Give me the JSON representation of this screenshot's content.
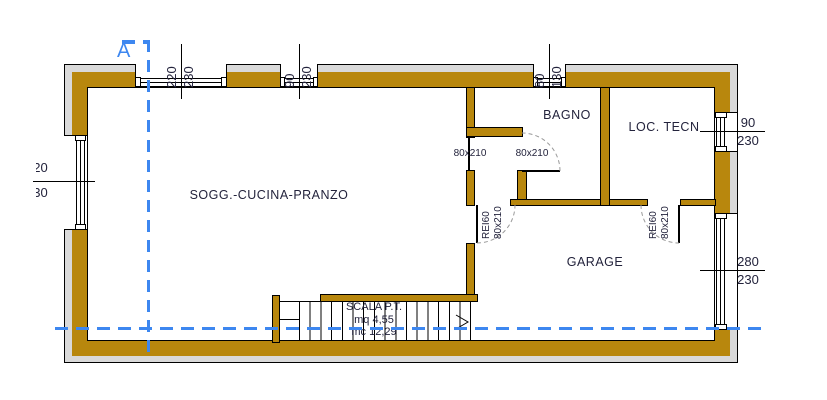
{
  "section": {
    "label": "A"
  },
  "rooms": {
    "living": "SOGG.-CUCINA-PRANZO",
    "bathroom": "BAGNO",
    "tech_room": "LOC. TECN",
    "garage": "GARAGE"
  },
  "stairs": {
    "title": "SCALA P.T.",
    "area": "mq 4,55",
    "volume": "mc 12,29"
  },
  "doors": {
    "door1": "80x210",
    "door2": "80x210",
    "fire_door_1": {
      "rating": "REI60",
      "size": "80x210"
    },
    "fire_door_2": {
      "rating": "REI60",
      "size": "80x210"
    }
  },
  "dimensions": {
    "top_window_1": {
      "w": "220",
      "h": "230"
    },
    "top_window_2": {
      "w": "90",
      "h": "230"
    },
    "top_window_3": {
      "w": "80",
      "h": "130"
    },
    "left_window": {
      "w": "220",
      "h": "230"
    },
    "tech_window": {
      "w": "90",
      "h": "230"
    },
    "garage_window": {
      "w": "280",
      "h": "230"
    }
  },
  "colors": {
    "wall": "#b8870d",
    "band": "#d9d9d9",
    "section": "#3d87f0",
    "ink": "#23233c"
  }
}
